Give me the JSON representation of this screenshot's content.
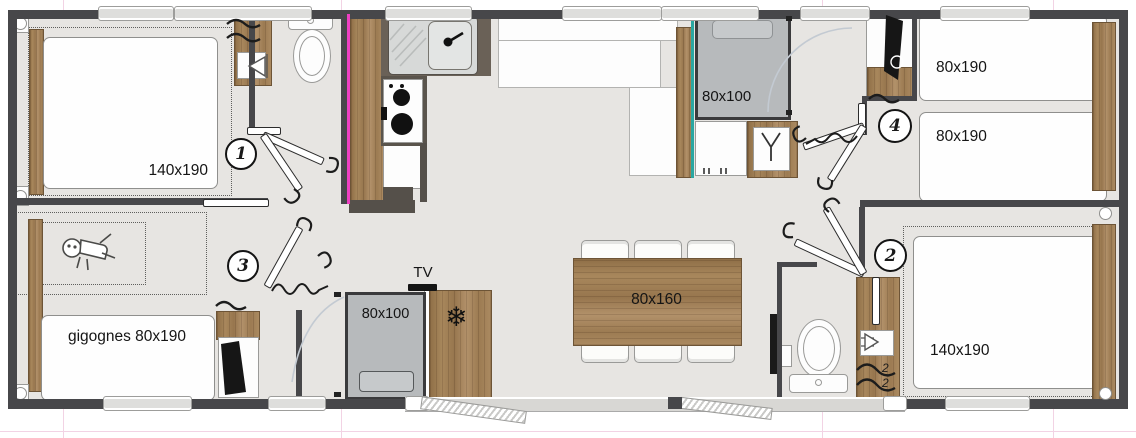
{
  "plan": {
    "rooms": {
      "bedroom1": {
        "number": "1",
        "bed_label": "140x190"
      },
      "bedroom2": {
        "number": "2",
        "bed_label": "140x190",
        "hanger_marks": [
          "2",
          "2"
        ]
      },
      "bedroom3": {
        "number": "3",
        "bed_label": "gigognes 80x190"
      },
      "bedroom4": {
        "number": "4",
        "bed_top_label": "80x190",
        "bed_bottom_label": "80x190"
      },
      "bathroom": {
        "shower_label": "80x100"
      },
      "shower_room": {
        "shower_label": "80x100"
      },
      "living": {
        "table_label": "80x160",
        "tv_label": "TV",
        "freezer_icon": "❄"
      }
    },
    "colors": {
      "wall": "#47474a",
      "floor": "#e7e5e2",
      "wood": "#a8875c",
      "shower_gray": "#b7babc",
      "accent_magenta": "#ee3fc2",
      "accent_teal": "#2aa7a2"
    }
  }
}
